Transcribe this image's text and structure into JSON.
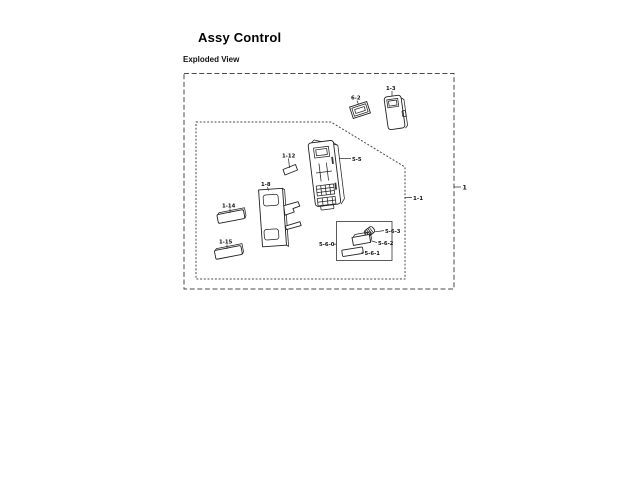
{
  "page": {
    "title": "Assy Control",
    "section_label": "Exploded View"
  },
  "diagram": {
    "callouts": {
      "assembly": "1",
      "panel_assembly": "1-1"
    },
    "parts": {
      "holder_support": "1-3",
      "membrane_window": "6-2",
      "control_panel": "5-5",
      "key_chip": "1-12",
      "pba_main": "1-8",
      "key_bar_top": "1-14",
      "key_bar_bottom": "1-15",
      "encoder_group": "5-6-0",
      "encoder_knob": "5-6-3",
      "encoder_body": "5-6-2",
      "encoder_plate": "5-6-1"
    }
  }
}
